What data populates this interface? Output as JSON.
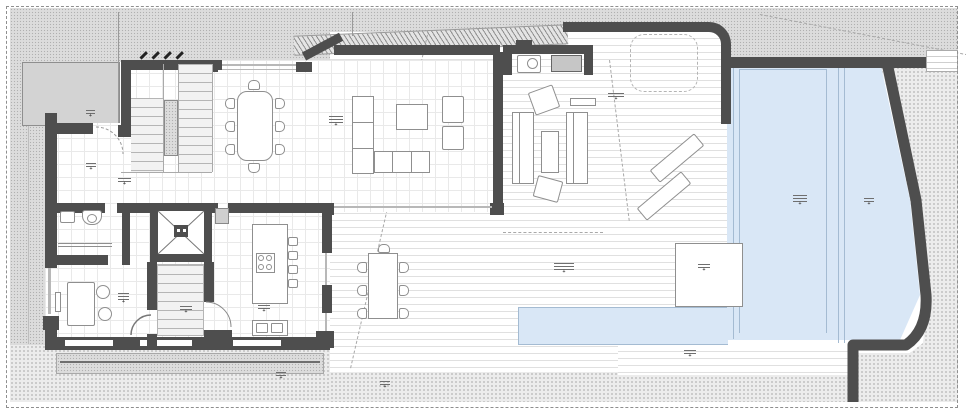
{
  "drawing": {
    "kind": "architectural floor plan, ground floor of a villa with terrace and infinity pool",
    "visible_text_note": "all annotation labels in the drawing are sub-5px elevation/room markers, illegible at source resolution; rendered as generic marker smudges with a cross symbol"
  },
  "palette": {
    "wall": "#4e4e4e",
    "win": "#b8b8b8",
    "pool": "#d9e7f6",
    "poolLine": "#a4bbd2",
    "grid": "#e9e9e9",
    "deckLine": "#e0e0e0",
    "furn": "#8f8f8f",
    "speckleBg": "#dcdcdc",
    "speckleDot": "#b0b0b0",
    "gravelBg": "#ececec",
    "gravelDot": "#c0c0c0",
    "canopy": "#d3d3d3",
    "hatchLine": "#8f8f8f",
    "dashLine": "#a8a8a8"
  },
  "markers": [
    {
      "x": 86,
      "y": 110,
      "w": 9,
      "lines": 1,
      "type": "elevation-marker"
    },
    {
      "x": 86,
      "y": 163,
      "w": 10,
      "lines": 1,
      "type": "elevation-marker"
    },
    {
      "x": 118,
      "y": 178,
      "w": 13,
      "lines": 1,
      "type": "room-label"
    },
    {
      "x": 329,
      "y": 116,
      "w": 14,
      "lines": 2,
      "type": "room-label"
    },
    {
      "x": 118,
      "y": 293,
      "w": 11,
      "lines": 2,
      "type": "room-label"
    },
    {
      "x": 180,
      "y": 306,
      "w": 12,
      "lines": 1,
      "type": "room-label"
    },
    {
      "x": 258,
      "y": 305,
      "w": 12,
      "lines": 1,
      "type": "room-label"
    },
    {
      "x": 554,
      "y": 263,
      "w": 20,
      "lines": 2,
      "type": "area-label"
    },
    {
      "x": 698,
      "y": 264,
      "w": 12,
      "lines": 1,
      "type": "area-label"
    },
    {
      "x": 793,
      "y": 195,
      "w": 14,
      "lines": 2,
      "type": "pool-label"
    },
    {
      "x": 864,
      "y": 198,
      "w": 10,
      "lines": 1,
      "type": "pool-label"
    },
    {
      "x": 684,
      "y": 350,
      "w": 12,
      "lines": 1,
      "type": "elevation-marker"
    },
    {
      "x": 380,
      "y": 381,
      "w": 10,
      "lines": 1,
      "type": "elevation-marker"
    },
    {
      "x": 276,
      "y": 372,
      "w": 10,
      "lines": 1,
      "type": "elevation-marker"
    },
    {
      "x": 608,
      "y": 93,
      "w": 16,
      "lines": 1,
      "type": "furniture-label"
    }
  ]
}
